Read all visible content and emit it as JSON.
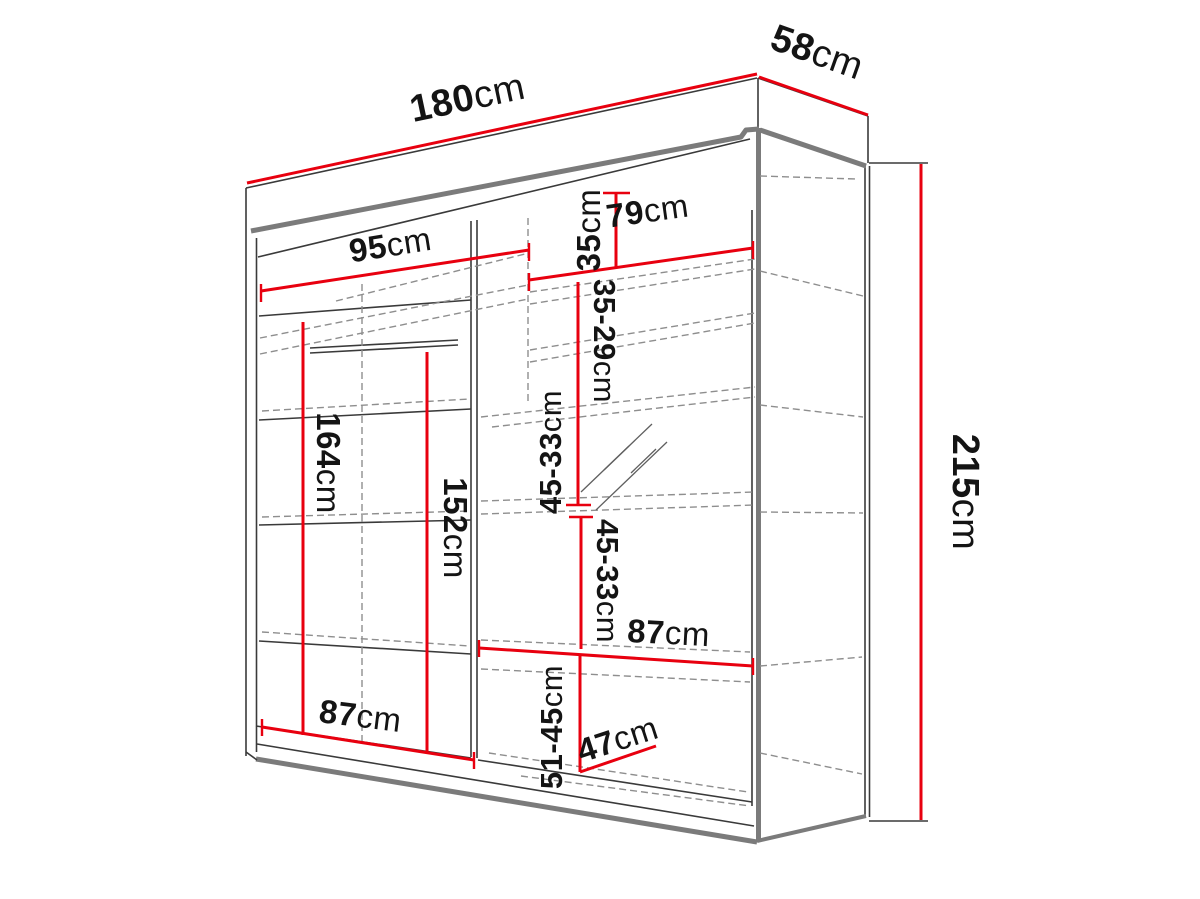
{
  "page": {
    "background": "#ffffff",
    "accent_color": "#e8000f",
    "line_color": "#3a3a3a",
    "panel_edge_color": "#7b7b7b"
  },
  "diagram": {
    "kind": "wardrobe-dimension-diagram",
    "unit_default": "cm"
  },
  "dimensions": {
    "width": {
      "value": "180",
      "unit": "cm"
    },
    "depth": {
      "value": "58",
      "unit": "cm"
    },
    "height": {
      "value": "215",
      "unit": "cm"
    },
    "left_section_width": {
      "value": "95",
      "unit": "cm"
    },
    "right_section_width": {
      "value": "79",
      "unit": "cm"
    },
    "top_shelf_gap": {
      "value": "35",
      "unit": "cm"
    },
    "upper_shelf_gap": {
      "value": "35-29",
      "unit": "cm"
    },
    "left_hanging_height": {
      "value": "164",
      "unit": "cm"
    },
    "rod_height": {
      "value": "152",
      "unit": "cm"
    },
    "mid_shelf_gap_upper": {
      "value": "45-33",
      "unit": "cm"
    },
    "mid_shelf_gap_lower": {
      "value": "45-33",
      "unit": "cm"
    },
    "right_shelf_width": {
      "value": "87",
      "unit": "cm"
    },
    "bottom_left_width": {
      "value": "87",
      "unit": "cm"
    },
    "bottom_shelf_gap": {
      "value": "51-45",
      "unit": "cm"
    },
    "usable_depth": {
      "value": "47",
      "unit": "cm"
    }
  }
}
